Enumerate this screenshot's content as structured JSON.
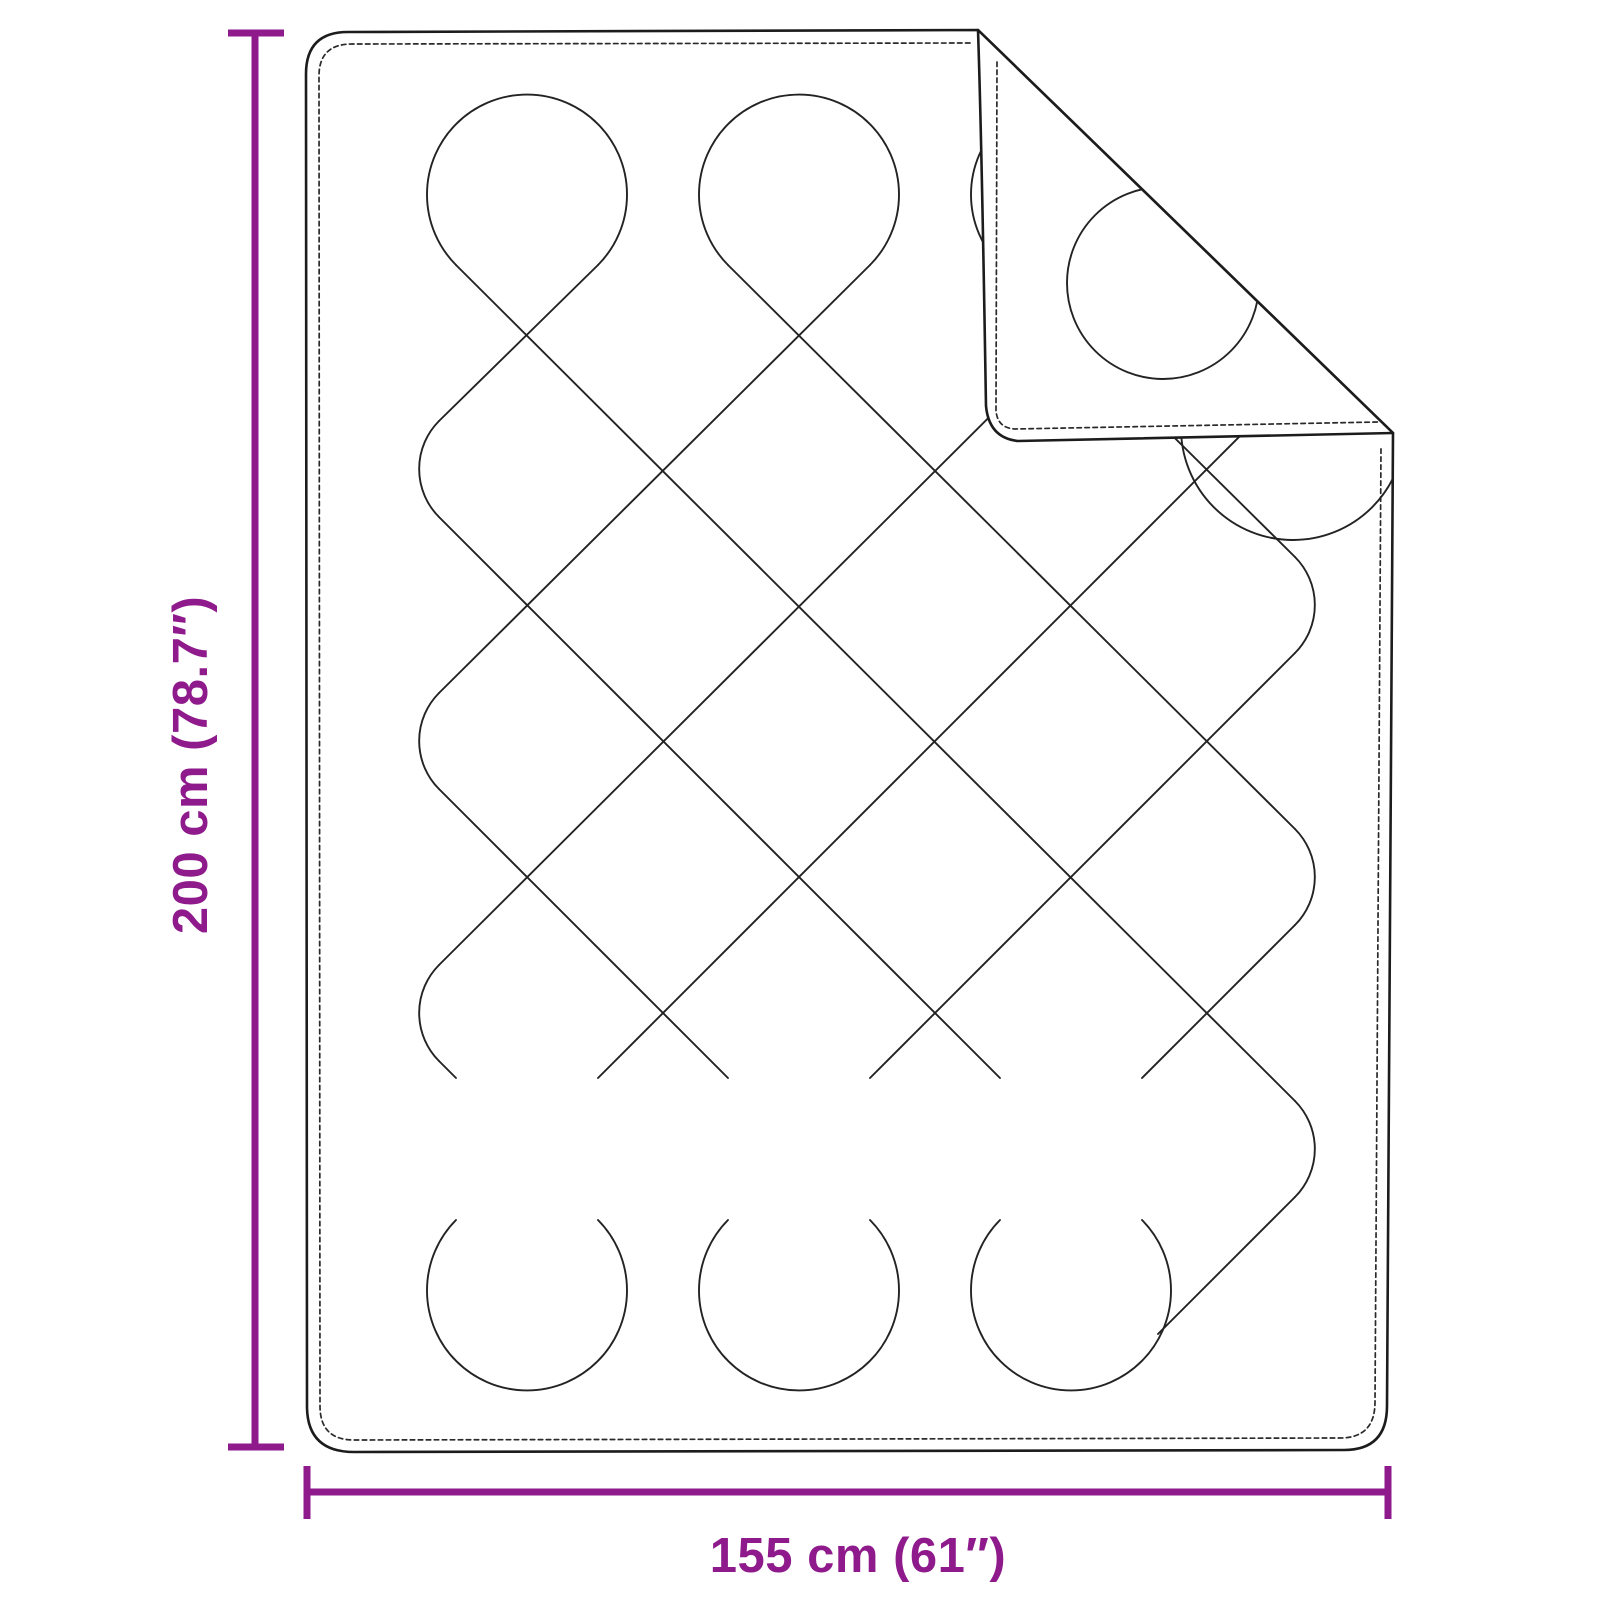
{
  "diagram": {
    "title": "blanket-dimension-diagram",
    "dimensions": {
      "height": {
        "label": "200 cm (78.7″)",
        "value_cm": 200,
        "value_in": 78.7
      },
      "width": {
        "label": "155 cm (61″)",
        "value_cm": 155,
        "value_in": 61
      }
    },
    "colors": {
      "accent": "#8E1A8C",
      "ink": "#1c1c1c",
      "stitch": "#2a2a2a",
      "background": "#ffffff"
    }
  }
}
